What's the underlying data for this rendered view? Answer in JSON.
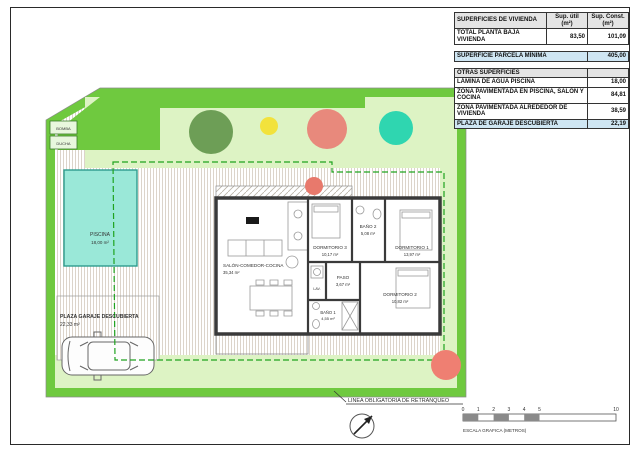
{
  "tables": {
    "vivienda": {
      "title": "SUPERFICIES DE VIVIENDA",
      "col_util": "Sup. útil (m²)",
      "col_const": "Sup. Const. (m²)",
      "row": {
        "label": "TOTAL PLANTA BAJA VIVIENDA",
        "util": "83,50",
        "const": "101,09"
      }
    },
    "parcela": {
      "label": "SUPERFICIE PARCELA MÍNIMA",
      "value": "405,00"
    },
    "otras": {
      "title": "OTRAS SUPERFICIES",
      "rows": [
        {
          "label": "LÁMINA DE AGUA PISCINA",
          "value": "18,00"
        },
        {
          "label": "ZONA PAVIMENTADA EN PISCINA, SALÓN Y COCINA",
          "value": "84,81"
        },
        {
          "label": "ZONA PAVIMENTADA ALREDEDOR DE VIVIENDA",
          "value": "38,59"
        },
        {
          "label": "PLAZA DE GARAJE DESCUBIERTA",
          "value": "22,19"
        }
      ]
    }
  },
  "plan": {
    "rooms": [
      {
        "name": "SALÓN-COMEDOR-COCINA",
        "area": "35,34 m²"
      },
      {
        "name": "DORMITORIO 3",
        "area": "10,17 m²"
      },
      {
        "name": "BAÑO 2",
        "area": "5,08 m²"
      },
      {
        "name": "DORMITORIO 1",
        "area": "13,97 m²"
      },
      {
        "name": "PASO",
        "area": "3,67 m²"
      },
      {
        "name": "DORMITORIO 2",
        "area": "10,82 m²"
      },
      {
        "name": "BAÑO 1",
        "area": "4,55 m²"
      },
      {
        "name": "LAV."
      }
    ],
    "pool": {
      "name": "PISCINA",
      "area": "18,00 m²"
    },
    "garage": {
      "name": "PLAZA GARAJE DESCUBIERTA",
      "area": "22,33 m²"
    },
    "equipment": {
      "box1": "BOMBA",
      "box2": "DUCHA"
    },
    "setback_label": "LINEA OBLIGATORIA DE RETRANQUEO"
  },
  "footer": {
    "scalebar": {
      "ticks": [
        "0",
        "1",
        "2",
        "3",
        "4",
        "5",
        "10"
      ],
      "label": "ESCALA GRAFICA (METROS)"
    }
  },
  "colors": {
    "hedge_green": "#6fc93f",
    "garden_green": "#ddf3c4",
    "pool_cyan": "#9ae8d8",
    "setback_dash_green": "#1fa31f",
    "highlight_row_blue": "#cfe6f3",
    "tree_dark_green": "#6d9e56",
    "tree_yellow": "#f2e23c",
    "tree_salmon": "#e8897c",
    "tree_turquoise": "#2fd6b0"
  }
}
